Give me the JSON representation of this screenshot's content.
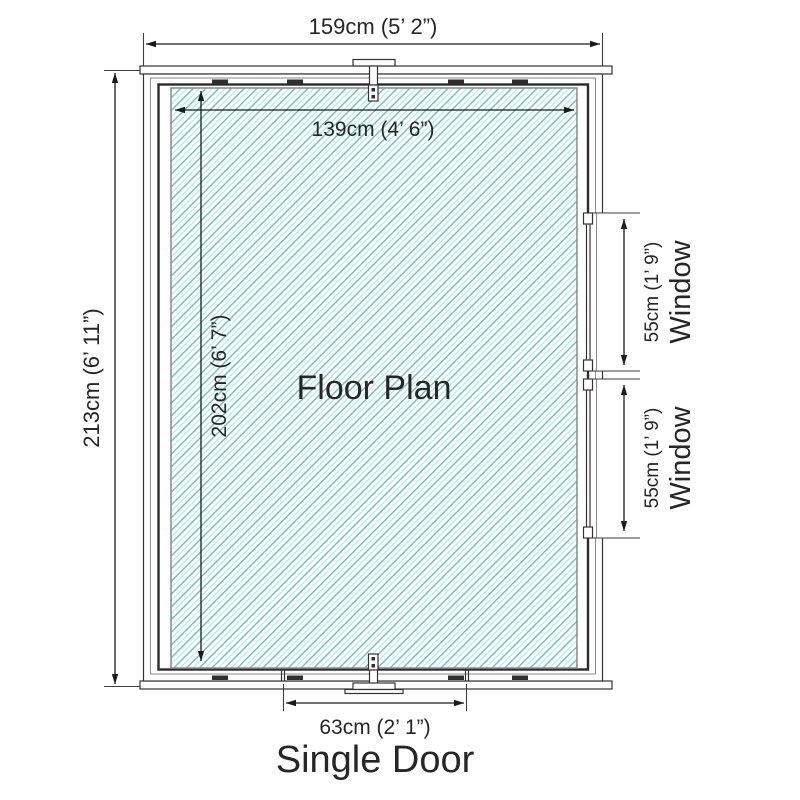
{
  "diagram": {
    "floor_label": "Floor Plan",
    "overall": {
      "width": "159cm (5’ 2”)",
      "depth": "213cm (6’ 11”)"
    },
    "internal": {
      "width": "139cm (4’ 6”)",
      "depth": "202cm (6’ 7”)"
    },
    "door": {
      "label": "Single Door",
      "width": "63cm (2’ 1”)"
    },
    "windows": [
      {
        "label": "Window",
        "height": "55cm (1’ 9”)"
      },
      {
        "label": "Window",
        "height": "55cm (1’ 9”)"
      }
    ],
    "colors": {
      "hatch_line": "#5cc6c0",
      "hatch_line_light": "#b5e6e2",
      "outline": "#2a2a2a",
      "dim": "#1a1a1a",
      "text": "#262626"
    }
  }
}
